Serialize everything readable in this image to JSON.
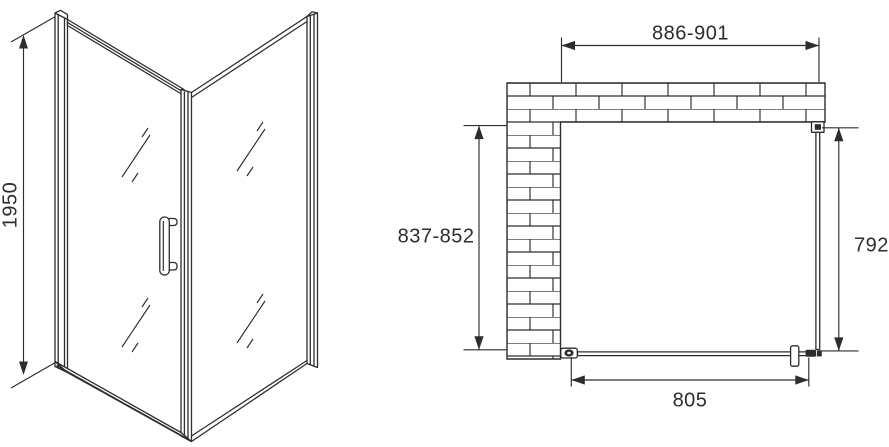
{
  "drawing": {
    "colors": {
      "background": "#ffffff",
      "line": "#2d2d2d",
      "text": "#2d2d2d"
    },
    "elevation_view": {
      "height_label": "1950"
    },
    "plan_view": {
      "width_label": "886-901",
      "depth_label": "837-852",
      "side_panel_label": "792",
      "door_width_label": "805"
    }
  }
}
